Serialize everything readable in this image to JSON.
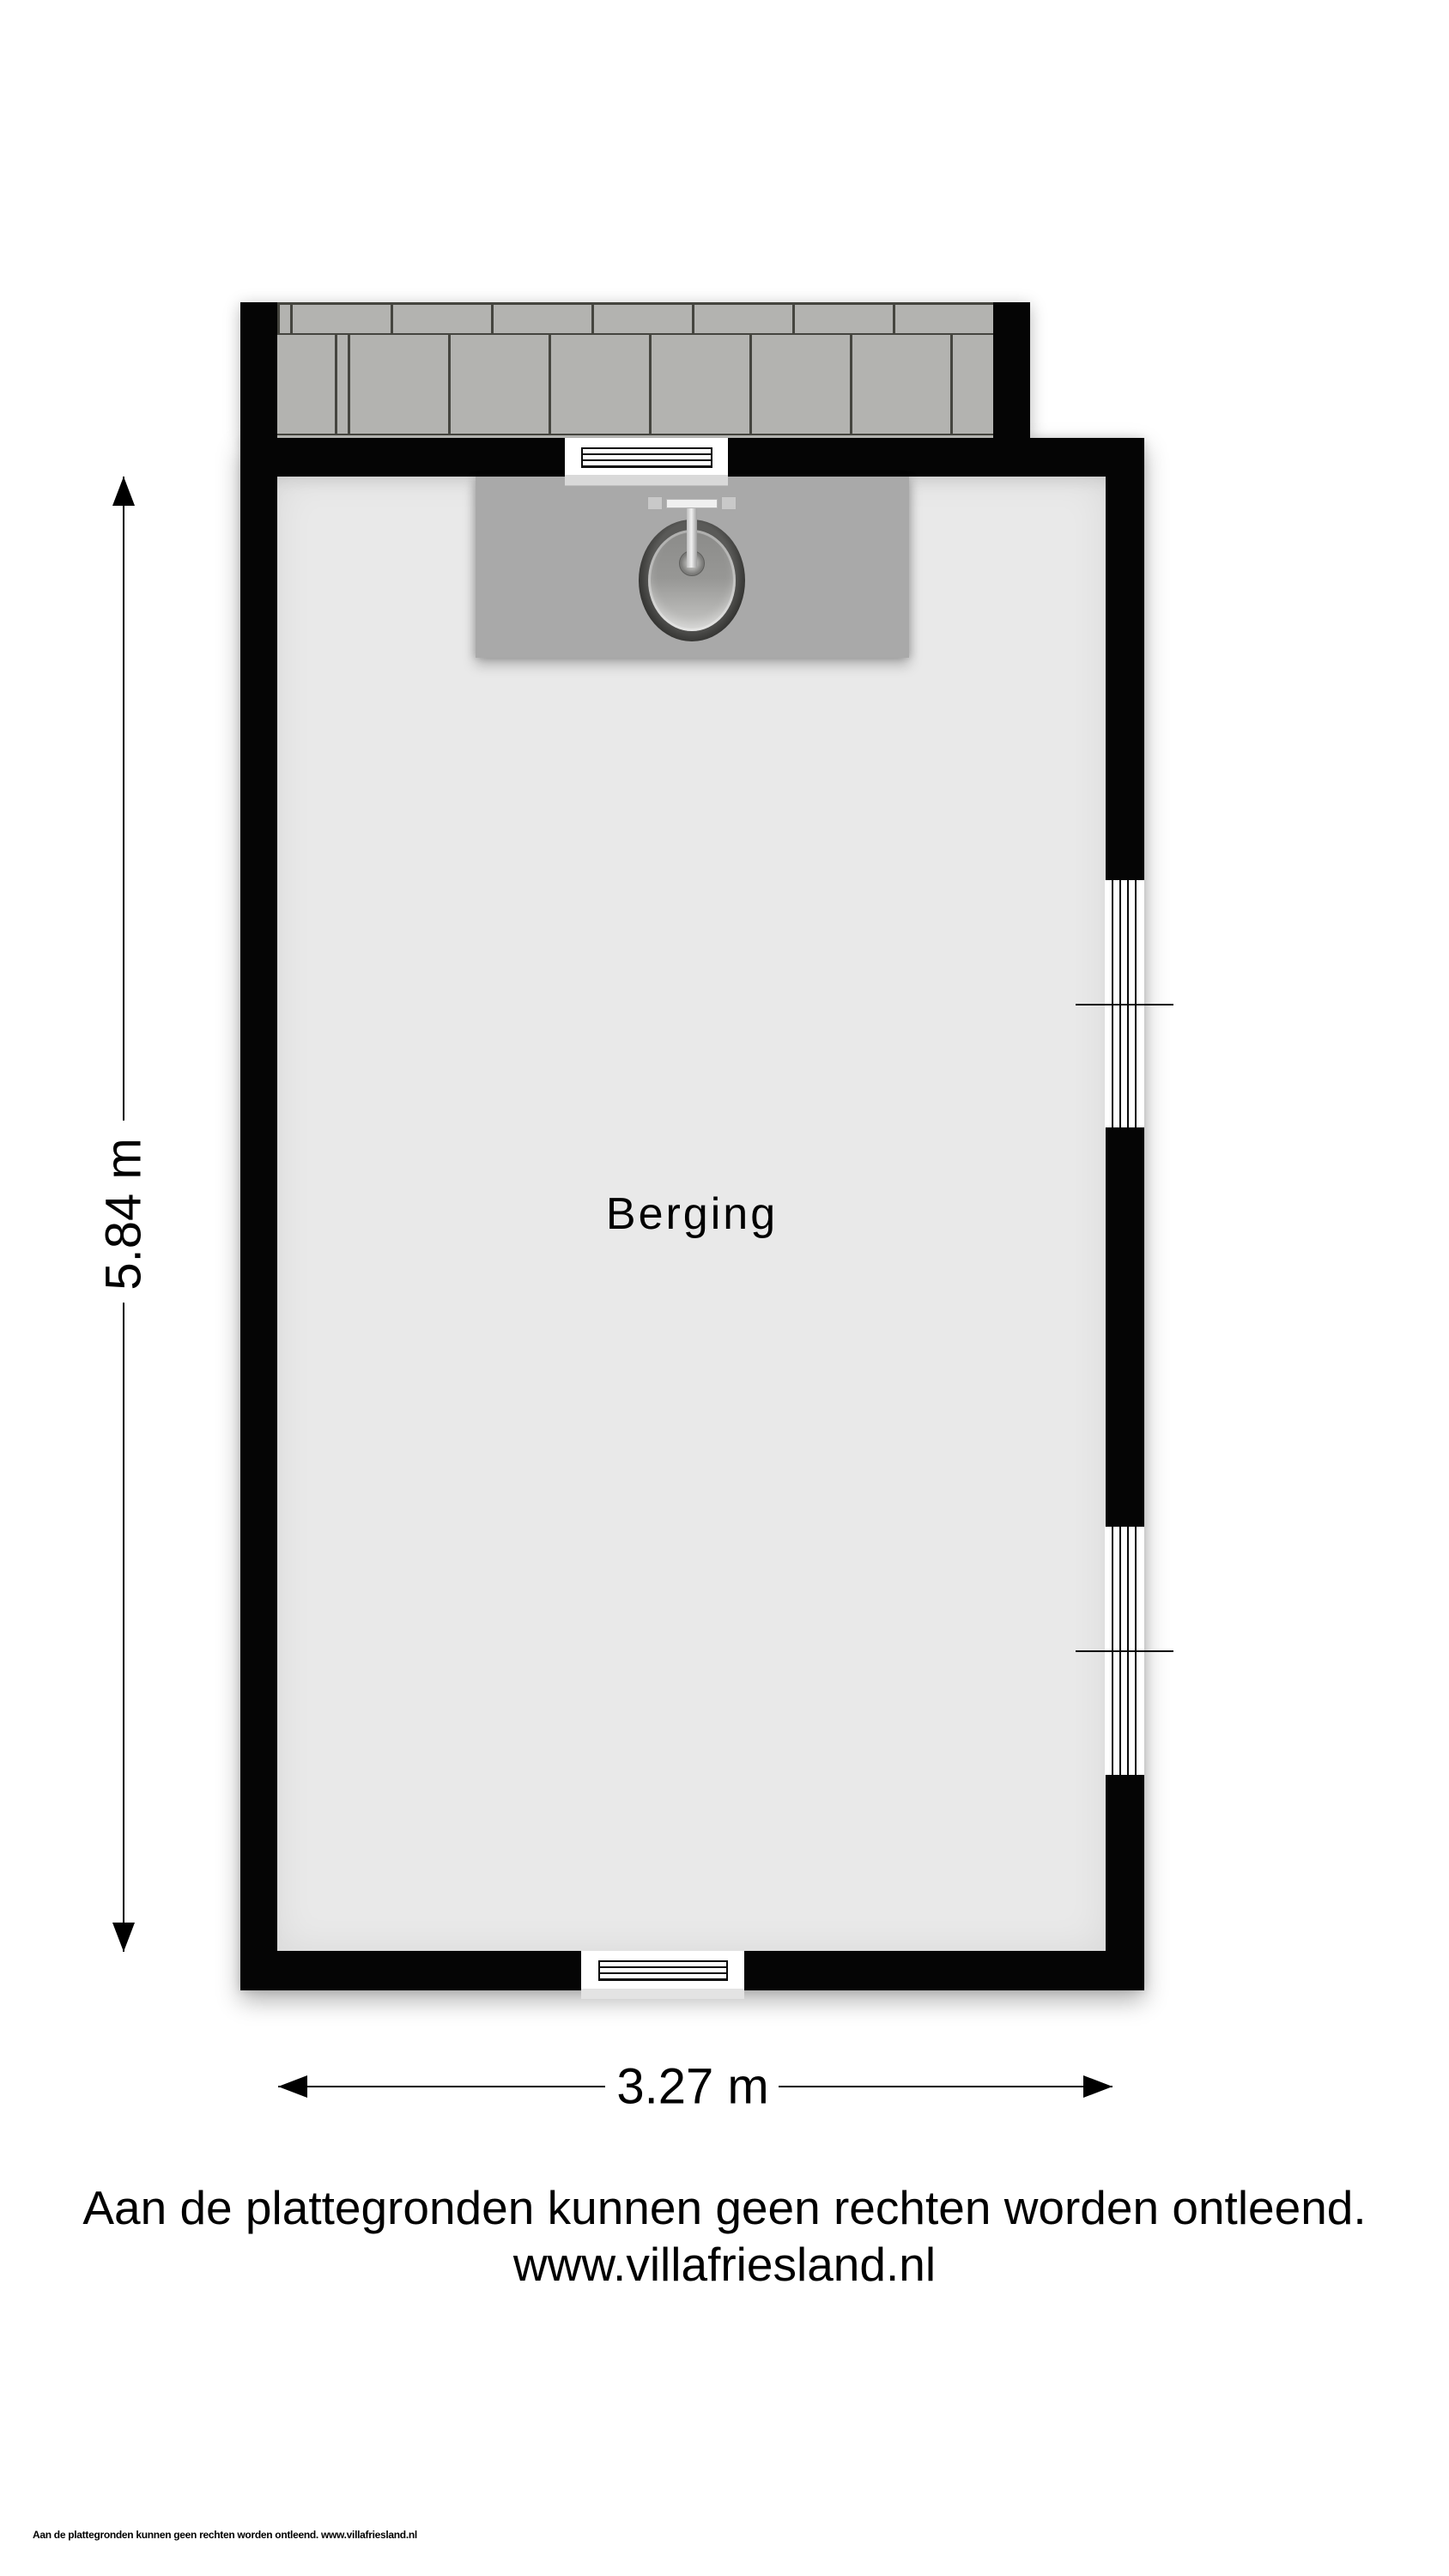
{
  "floorplan": {
    "room_label": "Berging",
    "dimensions": {
      "height_label": "5.84 m",
      "width_label": "3.27 m"
    },
    "fixtures": {
      "sink": "sink",
      "faucet": "faucet",
      "counter": "counter",
      "terrace": "paved-tiles"
    },
    "colors": {
      "wall": "#050505",
      "floor": "#e9e9e9",
      "counter": "#a9a9a9",
      "tile": "#b3b3b0",
      "grout": "#45453f",
      "sill": "#d9d9d9"
    }
  },
  "disclaimer": {
    "line1": "Aan de plattegronden kunnen geen rechten worden ontleend.",
    "line2": "www.villafriesland.nl"
  },
  "footer": {
    "text": "Aan de plattegronden kunnen geen rechten worden ontleend. www.villafriesland.nl"
  }
}
